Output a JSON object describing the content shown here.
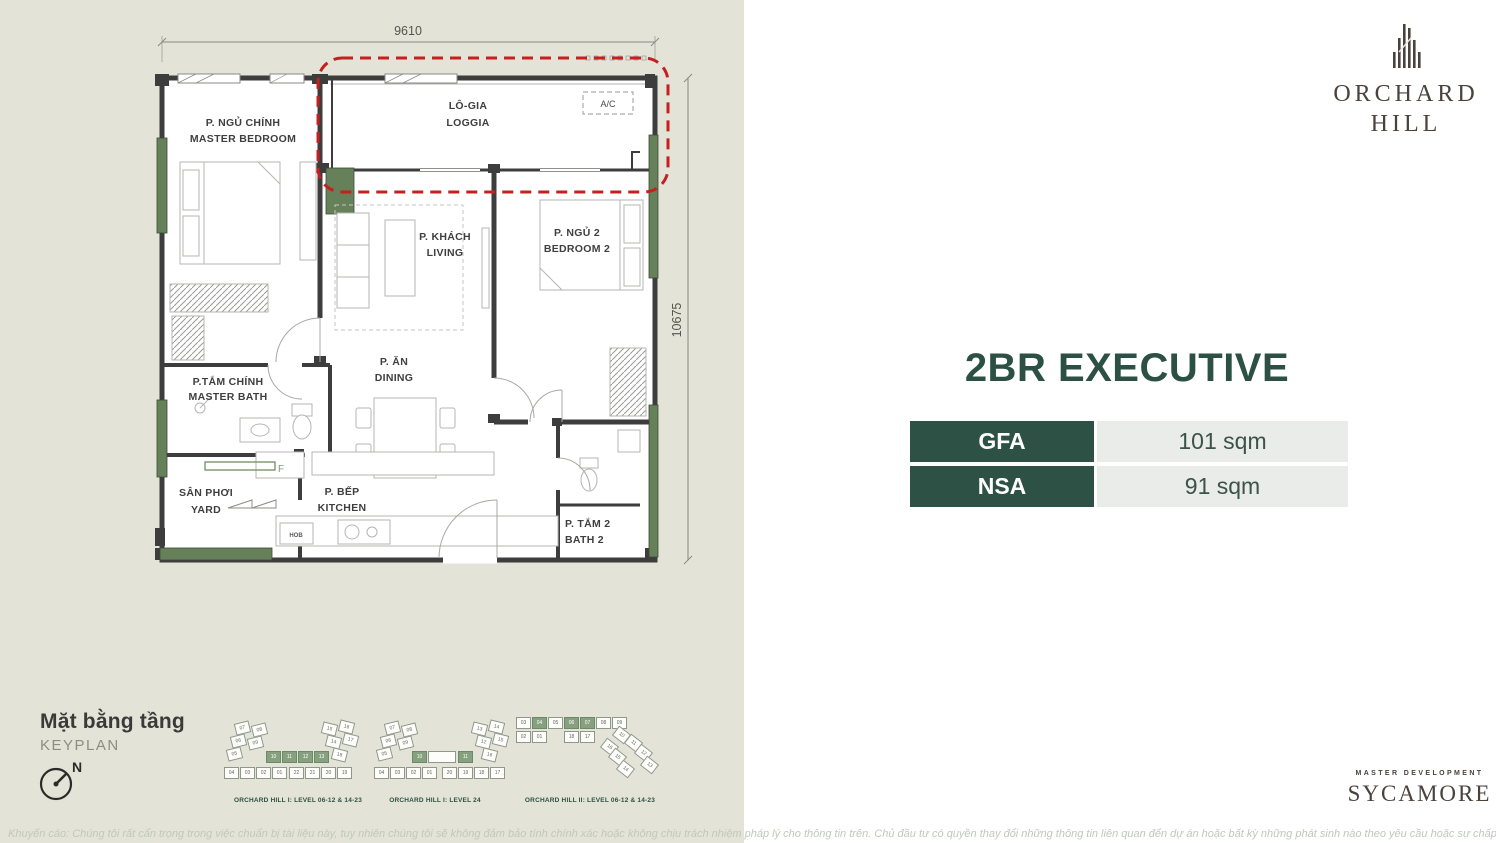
{
  "colors": {
    "left_background": "#e4e3d8",
    "wall": "#3d3d3d",
    "exterior_green": "#66815a",
    "highlight_red": "#c42020",
    "accent_dark_green": "#2d5144",
    "table_light_cell": "#e9ece8",
    "brand_brown": "#4a423c"
  },
  "plan": {
    "dim_width": "9610",
    "dim_height": "10675",
    "ac_label": "A/C",
    "fridge_label": "F",
    "hob_label": "HOB",
    "rooms": {
      "master_bedroom": {
        "vi": "P. NGỦ CHÍNH",
        "en": "MASTER BEDROOM"
      },
      "loggia": {
        "vi": "LÔ-GIA",
        "en": "LOGGIA"
      },
      "living": {
        "vi": "P. KHÁCH",
        "en": "LIVING"
      },
      "bedroom2": {
        "vi": "P. NGỦ 2",
        "en": "BEDROOM 2"
      },
      "dining": {
        "vi": "P. ĂN",
        "en": "DINING"
      },
      "master_bath": {
        "vi": "P.TẮM CHÍNH",
        "en": "MASTER BATH"
      },
      "yard": {
        "vi": "SÂN PHƠI",
        "en": "YARD"
      },
      "kitchen": {
        "vi": "P. BẾP",
        "en": "KITCHEN"
      },
      "bath2": {
        "vi": "P. TẮM 2",
        "en": "BATH 2"
      }
    }
  },
  "keyplan": {
    "title_vi": "Mặt bằng tầng",
    "title_en": "KEYPLAN",
    "north_label": "N",
    "plans": [
      {
        "caption": "ORCHARD HILL I: LEVEL 06-12 & 14-23",
        "blocks": [
          {
            "t": "07",
            "x": 13,
            "y": 0,
            "r": -14
          },
          {
            "t": "08",
            "x": 30,
            "y": 2,
            "r": -14
          },
          {
            "t": "06",
            "x": 9,
            "y": 13,
            "r": -14
          },
          {
            "t": "09",
            "x": 26,
            "y": 15,
            "r": -14
          },
          {
            "t": "05",
            "x": 5,
            "y": 26,
            "r": -14
          },
          {
            "t": "10",
            "x": 44,
            "y": 29,
            "g": true
          },
          {
            "t": "11",
            "x": 60,
            "y": 29,
            "g": true
          },
          {
            "t": "12",
            "x": 76,
            "y": 29,
            "g": true
          },
          {
            "t": "13",
            "x": 92,
            "y": 29,
            "g": true
          },
          {
            "t": "04",
            "x": 2,
            "y": 45
          },
          {
            "t": "03",
            "x": 18,
            "y": 45
          },
          {
            "t": "02",
            "x": 34,
            "y": 45
          },
          {
            "t": "01",
            "x": 50,
            "y": 45
          },
          {
            "t": "22",
            "x": 67,
            "y": 45
          },
          {
            "t": "21",
            "x": 83,
            "y": 45
          },
          {
            "t": "20",
            "x": 99,
            "y": 45
          },
          {
            "t": "19",
            "x": 115,
            "y": 45
          },
          {
            "t": "15",
            "x": 100,
            "y": 1,
            "r": 14
          },
          {
            "t": "16",
            "x": 117,
            "y": -1,
            "r": 14
          },
          {
            "t": "14",
            "x": 104,
            "y": 14,
            "r": 14
          },
          {
            "t": "17",
            "x": 121,
            "y": 12,
            "r": 14
          },
          {
            "t": "18",
            "x": 110,
            "y": 27,
            "r": 14
          }
        ]
      },
      {
        "caption": "ORCHARD HILL I: LEVEL 24",
        "blocks": [
          {
            "t": "07",
            "x": 13,
            "y": 0,
            "r": -14
          },
          {
            "t": "08",
            "x": 30,
            "y": 2,
            "r": -14
          },
          {
            "t": "06",
            "x": 9,
            "y": 13,
            "r": -14
          },
          {
            "t": "09",
            "x": 26,
            "y": 15,
            "r": -14
          },
          {
            "t": "05",
            "x": 5,
            "y": 26,
            "r": -14
          },
          {
            "t": "10",
            "x": 40,
            "y": 29,
            "g": true
          },
          {
            "t": "",
            "x": 56,
            "y": 29,
            "w": 28
          },
          {
            "t": "11",
            "x": 86,
            "y": 29,
            "g": true
          },
          {
            "t": "04",
            "x": 2,
            "y": 45
          },
          {
            "t": "03",
            "x": 18,
            "y": 45
          },
          {
            "t": "02",
            "x": 34,
            "y": 45
          },
          {
            "t": "01",
            "x": 50,
            "y": 45
          },
          {
            "t": "20",
            "x": 70,
            "y": 45
          },
          {
            "t": "19",
            "x": 86,
            "y": 45
          },
          {
            "t": "18",
            "x": 102,
            "y": 45
          },
          {
            "t": "17",
            "x": 118,
            "y": 45
          },
          {
            "t": "13",
            "x": 100,
            "y": 1,
            "r": 14
          },
          {
            "t": "14",
            "x": 117,
            "y": -1,
            "r": 14
          },
          {
            "t": "12",
            "x": 104,
            "y": 14,
            "r": 14
          },
          {
            "t": "15",
            "x": 121,
            "y": 12,
            "r": 14
          },
          {
            "t": "16",
            "x": 110,
            "y": 27,
            "r": 14
          }
        ]
      },
      {
        "caption": "ORCHARD HILL II: LEVEL 06-12 & 14-23",
        "blocks": [
          {
            "t": "03",
            "x": 0,
            "y": 0
          },
          {
            "t": "04",
            "x": 16,
            "y": 0,
            "g": true
          },
          {
            "t": "05",
            "x": 32,
            "y": 0
          },
          {
            "t": "06",
            "x": 48,
            "y": 0,
            "g": true
          },
          {
            "t": "07",
            "x": 64,
            "y": 0,
            "g": true
          },
          {
            "t": "08",
            "x": 80,
            "y": 0
          },
          {
            "t": "09",
            "x": 96,
            "y": 0
          },
          {
            "t": "02",
            "x": 0,
            "y": 14
          },
          {
            "t": "01",
            "x": 16,
            "y": 14
          },
          {
            "t": "18",
            "x": 48,
            "y": 14
          },
          {
            "t": "17",
            "x": 64,
            "y": 14
          },
          {
            "t": "10",
            "x": 98,
            "y": 12,
            "r": 38
          },
          {
            "t": "16",
            "x": 86,
            "y": 24,
            "r": 38
          },
          {
            "t": "11",
            "x": 110,
            "y": 20,
            "r": 38
          },
          {
            "t": "15",
            "x": 94,
            "y": 34,
            "r": 38
          },
          {
            "t": "12",
            "x": 120,
            "y": 30,
            "r": 38
          },
          {
            "t": "14",
            "x": 102,
            "y": 46,
            "r": 38
          },
          {
            "t": "13",
            "x": 126,
            "y": 42,
            "r": 38
          }
        ]
      }
    ]
  },
  "right_panel": {
    "logo": {
      "name_line1": "ORCHARD",
      "name_line2": "HILL"
    },
    "title": "2BR EXECUTIVE",
    "table": {
      "rows": [
        {
          "label": "GFA",
          "value": "101 sqm"
        },
        {
          "label": "NSA",
          "value": "91 sqm"
        }
      ]
    },
    "footer_brand": {
      "eyebrow": "MASTER DEVELOPMENT",
      "name": "SYCAMORE"
    }
  },
  "disclaimer": "Khuyến cáo: Chúng tôi rất cẩn trọng trong việc chuẩn bị tài liệu này, tuy nhiên chúng tôi sẽ không đảm bảo tính chính xác hoặc không chịu trách nhiệm pháp lý cho thông tin trên. Chủ đầu tư có quyền thay đổi những thông tin liên quan đến dự án hoặc bất kỳ những phát sinh nào theo yêu cầu hoặc sự chấp thuận của cơ quan nhà nước có thẩm quyền"
}
